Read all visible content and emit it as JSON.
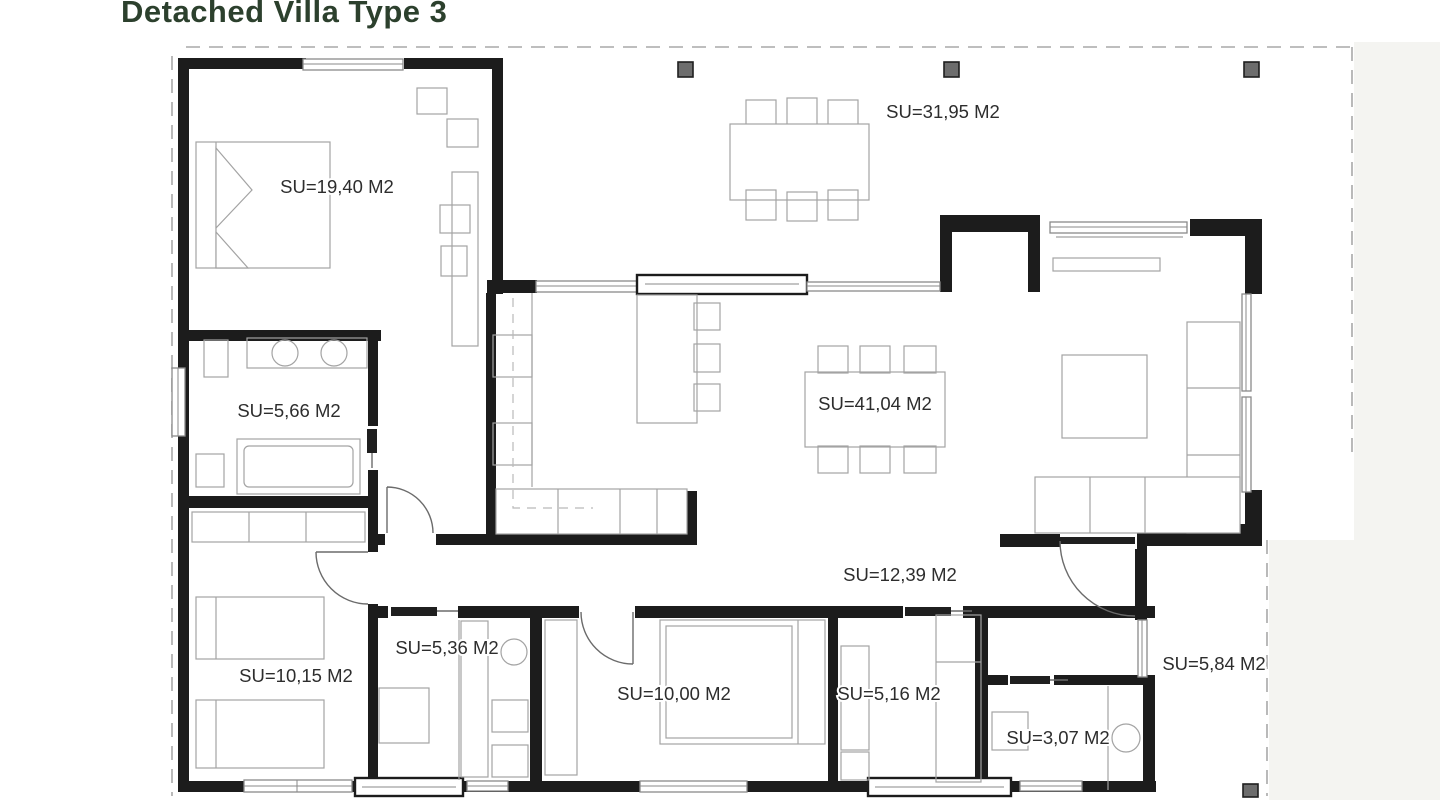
{
  "title": "Detached Villa Type 3",
  "colors": {
    "title": "#2c402d",
    "walls": "#1c1c1c",
    "furniture": "#a3a3a3",
    "boundary_dash": "#a8a8a8",
    "background": "#ffffff"
  },
  "rooms": [
    {
      "id": "master-bedroom",
      "label": "SU=19,40 M2"
    },
    {
      "id": "terrace",
      "label": "SU=31,95 M2"
    },
    {
      "id": "bathroom-1",
      "label": "SU=5,66 M2"
    },
    {
      "id": "living-dining",
      "label": "SU=41,04 M2"
    },
    {
      "id": "hallway",
      "label": "SU=12,39 M2"
    },
    {
      "id": "bedroom-2",
      "label": "SU=10,15 M2"
    },
    {
      "id": "bathroom-2",
      "label": "SU=5,36 M2"
    },
    {
      "id": "bedroom-3",
      "label": "SU=10,00 M2"
    },
    {
      "id": "bathroom-3",
      "label": "SU=5,16 M2"
    },
    {
      "id": "toilet",
      "label": "SU=3,07 M2"
    },
    {
      "id": "entrance-porch",
      "label": "SU=5,84 M2"
    }
  ]
}
